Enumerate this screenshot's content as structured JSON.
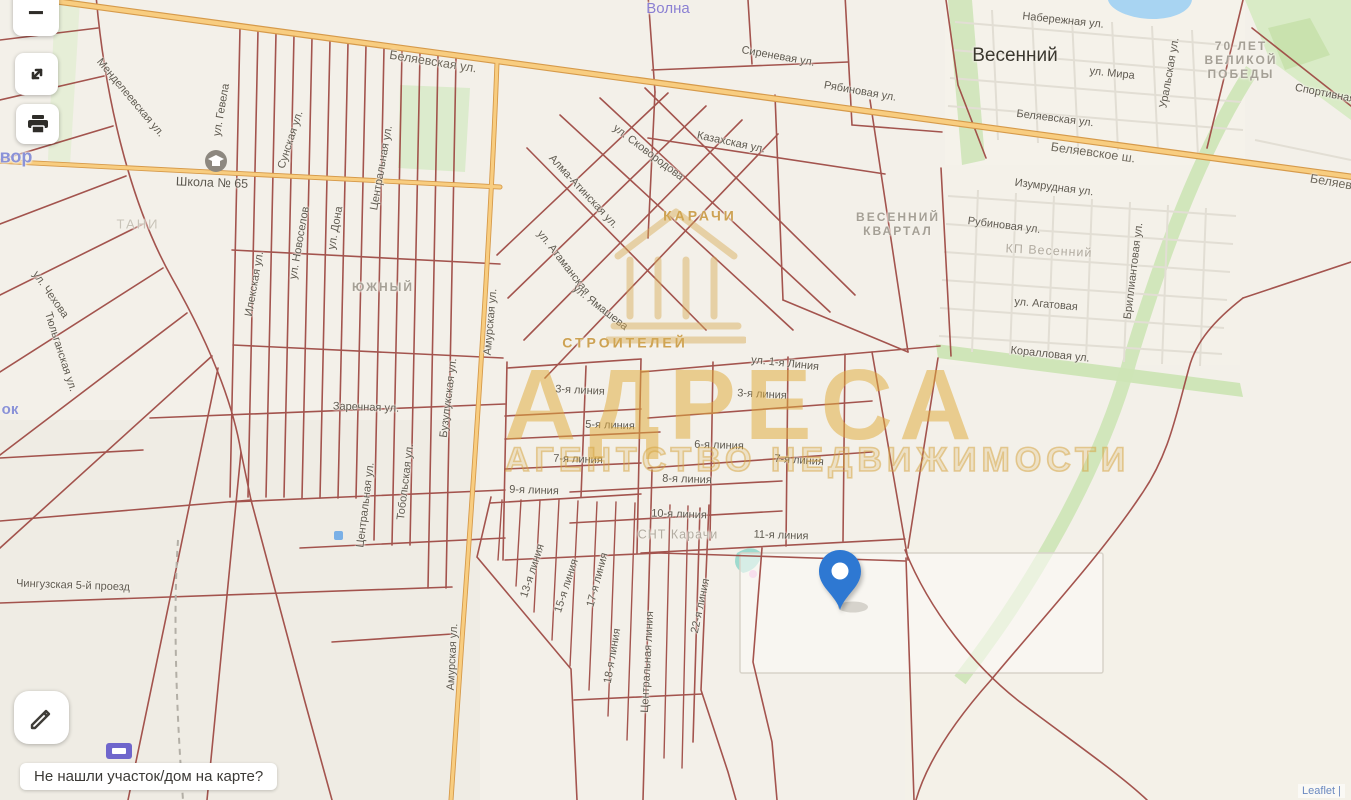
{
  "ui": {
    "zoom_out_label": "−",
    "bottom_bar_text": "Не нашли участок/дом на карте?",
    "attribution": "Leaflet |"
  },
  "watermark": {
    "title": "АДРЕСА",
    "subtitle": "АГЕНТСТВО НЕДВИЖИМОСТИ"
  },
  "pin": {
    "x": 840,
    "y": 610,
    "color": "#2e78d2"
  },
  "colors": {
    "highway_fill": "#f8cd80",
    "highway_casing": "#d69a4a",
    "parcel_line": "#9d4741",
    "green_area": "#d5e8c0",
    "water": "#a8d4f2",
    "watermark_gold": "#d8a94f",
    "pin_blue": "#2e78d2"
  },
  "labels": [
    {
      "t": "Беляевская ул.",
      "x": 433,
      "y": 62,
      "r": 9,
      "c": "main"
    },
    {
      "t": "Волна",
      "x": 668,
      "y": 9,
      "r": 0,
      "c": "purple"
    },
    {
      "t": "Сиреневая ул.",
      "x": 778,
      "y": 57,
      "r": 10
    },
    {
      "t": "Рябиновая ул.",
      "x": 860,
      "y": 92,
      "r": 10
    },
    {
      "t": "Весенний",
      "x": 1015,
      "y": 56,
      "r": 0,
      "c": "town"
    },
    {
      "t": "Набережная ул.",
      "x": 1063,
      "y": 21,
      "r": 6
    },
    {
      "t": "ул. Мира",
      "x": 1112,
      "y": 74,
      "r": 6
    },
    {
      "t": "Уральская ул.",
      "x": 1170,
      "y": 73,
      "r": -80
    },
    {
      "t": "70 ЛЕТ\nВЕЛИКОЙ\nПОБЕДЫ",
      "x": 1241,
      "y": 60,
      "r": 0,
      "c": "dist"
    },
    {
      "t": "Спортивная",
      "x": 1325,
      "y": 94,
      "r": 11
    },
    {
      "t": "Беляевская ул.",
      "x": 1055,
      "y": 119,
      "r": 7
    },
    {
      "t": "Беляевское ш.",
      "x": 1093,
      "y": 153,
      "r": 8,
      "c": "main"
    },
    {
      "t": "Беляевское ш.",
      "x": 1352,
      "y": 186,
      "r": 10,
      "c": "main"
    },
    {
      "t": "Изумрудная ул.",
      "x": 1054,
      "y": 188,
      "r": 7
    },
    {
      "t": "Рубиновая ул.",
      "x": 1004,
      "y": 226,
      "r": 7
    },
    {
      "t": "КП Весенний",
      "x": 1049,
      "y": 251,
      "r": 3,
      "c": "distsm"
    },
    {
      "t": "ул. Агатовая",
      "x": 1046,
      "y": 305,
      "r": 5
    },
    {
      "t": "Бриллиантовая ул.",
      "x": 1134,
      "y": 271,
      "r": -83
    },
    {
      "t": "Коралловая ул.",
      "x": 1050,
      "y": 355,
      "r": 6
    },
    {
      "t": "ВЕСЕННИЙ\nКВАРТАЛ",
      "x": 898,
      "y": 224,
      "r": 0,
      "c": "dist"
    },
    {
      "t": "Казахская ул.",
      "x": 731,
      "y": 143,
      "r": 12
    },
    {
      "t": "ул. Сковородова",
      "x": 648,
      "y": 153,
      "r": 37
    },
    {
      "t": "Алма-Атинская ул.",
      "x": 583,
      "y": 192,
      "r": 47
    },
    {
      "t": "ул. Атаманская",
      "x": 563,
      "y": 263,
      "r": 52
    },
    {
      "t": "ул. Ямашева",
      "x": 600,
      "y": 308,
      "r": 38
    },
    {
      "t": "КАРАЧИ",
      "x": 700,
      "y": 216,
      "r": 0,
      "c": "gold"
    },
    {
      "t": "СТРОИТЕЛЕЙ",
      "x": 625,
      "y": 343,
      "r": 0,
      "c": "gold"
    },
    {
      "t": "ул. 1-я Линия",
      "x": 785,
      "y": 364,
      "r": 6
    },
    {
      "t": "3-я линия",
      "x": 580,
      "y": 391,
      "r": 3
    },
    {
      "t": "3-я линия",
      "x": 762,
      "y": 395,
      "r": 3
    },
    {
      "t": "5-я линия",
      "x": 610,
      "y": 426,
      "r": 2
    },
    {
      "t": "7-я линия",
      "x": 578,
      "y": 460,
      "r": 2
    },
    {
      "t": "6-я линия",
      "x": 719,
      "y": 446,
      "r": 2
    },
    {
      "t": "7-я линия",
      "x": 799,
      "y": 461,
      "r": 4
    },
    {
      "t": "8-я линия",
      "x": 687,
      "y": 480,
      "r": 2
    },
    {
      "t": "9-я линия",
      "x": 534,
      "y": 491,
      "r": 2
    },
    {
      "t": "10-я линия",
      "x": 679,
      "y": 515,
      "r": 2
    },
    {
      "t": "11-я линия",
      "x": 781,
      "y": 536,
      "r": 2
    },
    {
      "t": "СНТ Карачи",
      "x": 678,
      "y": 535,
      "r": 0,
      "c": "distsm"
    },
    {
      "t": "13-я линия",
      "x": 533,
      "y": 571,
      "r": -72
    },
    {
      "t": "15-я линия",
      "x": 567,
      "y": 586,
      "r": -72
    },
    {
      "t": "17-я линия",
      "x": 598,
      "y": 580,
      "r": -75
    },
    {
      "t": "18-я линия",
      "x": 613,
      "y": 656,
      "r": -80
    },
    {
      "t": "Центральная линия",
      "x": 648,
      "y": 662,
      "r": -87
    },
    {
      "t": "22-я линия",
      "x": 701,
      "y": 606,
      "r": -78
    },
    {
      "t": "Школа № 65",
      "x": 212,
      "y": 183,
      "r": 2,
      "c": "poi"
    },
    {
      "t": "ЮЖНЫЙ",
      "x": 383,
      "y": 287,
      "r": 0,
      "c": "dist"
    },
    {
      "t": "ТАНИ",
      "x": 138,
      "y": 224,
      "r": 0,
      "c": "faint"
    },
    {
      "t": "Заречная ул.",
      "x": 366,
      "y": 408,
      "r": 2
    },
    {
      "t": "Центральная ул.",
      "x": 382,
      "y": 168,
      "r": -80
    },
    {
      "t": "Центральная ул.",
      "x": 366,
      "y": 505,
      "r": -83
    },
    {
      "t": "Тобольская ул.",
      "x": 406,
      "y": 482,
      "r": -83
    },
    {
      "t": "Бузулукская ул.",
      "x": 449,
      "y": 398,
      "r": -83
    },
    {
      "t": "Илекская ул.",
      "x": 255,
      "y": 284,
      "r": -80
    },
    {
      "t": "ул. Новоселов",
      "x": 300,
      "y": 243,
      "r": -80
    },
    {
      "t": "ул. Дона",
      "x": 336,
      "y": 228,
      "r": -80
    },
    {
      "t": "Сунская ул.",
      "x": 291,
      "y": 140,
      "r": -72
    },
    {
      "t": "ул. Гевела",
      "x": 222,
      "y": 110,
      "r": -80
    },
    {
      "t": "Менделеевская ул.",
      "x": 130,
      "y": 98,
      "r": 50
    },
    {
      "t": "ул. Чехова",
      "x": 50,
      "y": 295,
      "r": 55
    },
    {
      "t": "Тюльганская ул.",
      "x": 60,
      "y": 352,
      "r": 72
    },
    {
      "t": "Амурская ул.",
      "x": 491,
      "y": 322,
      "r": -85
    },
    {
      "t": "Амурская ул.",
      "x": 453,
      "y": 657,
      "r": -87
    },
    {
      "t": "Чингузская 5-й проезд",
      "x": 73,
      "y": 586,
      "r": 2
    },
    {
      "t": "вор",
      "x": 16,
      "y": 157,
      "r": 0,
      "c": "water"
    },
    {
      "t": "ок",
      "x": 10,
      "y": 410,
      "r": 0,
      "c": "water2"
    }
  ]
}
